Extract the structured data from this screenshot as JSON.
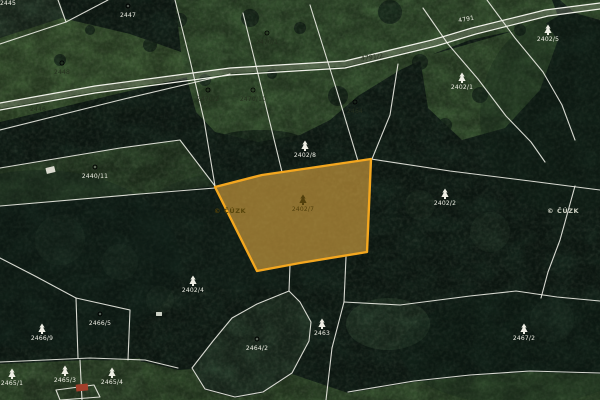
{
  "map": {
    "type": "cadastral-satellite-view",
    "colors": {
      "highlight_fill": "#e9ae43",
      "highlight_stroke": "#f4a71f",
      "boundary_line": "#f2f2ea",
      "meadow_green": "#5b8a51",
      "forest_green": "#20392b"
    },
    "highlighted_parcel": {
      "number": "2402/7",
      "symbol": "conifer"
    },
    "labels": [
      {
        "x": 303,
        "y": 200,
        "text": "2402/7",
        "symbol": "conifer",
        "tone": "accent",
        "rot": 0
      },
      {
        "x": 208,
        "y": 90,
        "text": "2470/2",
        "symbol": "circle",
        "tone": "dark",
        "rot": 0
      },
      {
        "x": 253,
        "y": 90,
        "text": "2470/10",
        "symbol": "circle",
        "tone": "dark",
        "rot": 0
      },
      {
        "x": 267,
        "y": 33,
        "text": "2470/1",
        "symbol": "circle",
        "tone": "dark",
        "rot": 0
      },
      {
        "x": 355,
        "y": 102,
        "text": "2464",
        "symbol": "circle",
        "tone": "dark",
        "rot": 0
      },
      {
        "x": 462,
        "y": 78,
        "text": "2402/1",
        "symbol": "conifer",
        "tone": "light",
        "rot": 0
      },
      {
        "x": 62,
        "y": 63,
        "text": "2448",
        "symbol": "circle",
        "tone": "dark",
        "rot": 0
      },
      {
        "x": 95,
        "y": 167,
        "text": "2440/11",
        "symbol": "circle",
        "tone": "light",
        "rot": 0
      },
      {
        "x": 305,
        "y": 146,
        "text": "2402/8",
        "symbol": "conifer",
        "tone": "light",
        "rot": 0
      },
      {
        "x": 445,
        "y": 194,
        "text": "2402/2",
        "symbol": "conifer",
        "tone": "light",
        "rot": 0
      },
      {
        "x": 548,
        "y": 30,
        "text": "2402/5",
        "symbol": "conifer",
        "tone": "light",
        "rot": 0
      },
      {
        "x": 128,
        "y": 6,
        "text": "2447",
        "symbol": "circle",
        "tone": "light",
        "rot": 0
      },
      {
        "x": 193,
        "y": 281,
        "text": "2402/4",
        "symbol": "conifer",
        "tone": "light",
        "rot": 0
      },
      {
        "x": 257,
        "y": 339,
        "text": "2464/2",
        "symbol": "circle",
        "tone": "light",
        "rot": 0
      },
      {
        "x": 322,
        "y": 324,
        "text": "2463",
        "symbol": "conifer",
        "tone": "light",
        "rot": 0
      },
      {
        "x": 524,
        "y": 329,
        "text": "2467/2",
        "symbol": "conifer",
        "tone": "light",
        "rot": 0
      },
      {
        "x": 42,
        "y": 329,
        "text": "2466/9",
        "symbol": "conifer",
        "tone": "light",
        "rot": 0
      },
      {
        "x": 100,
        "y": 314,
        "text": "2466/5",
        "symbol": "circle",
        "tone": "light",
        "rot": 0
      },
      {
        "x": 12,
        "y": 374,
        "text": "2465/1",
        "symbol": "conifer",
        "tone": "light",
        "rot": 0
      },
      {
        "x": 65,
        "y": 371,
        "text": "2465/3",
        "symbol": "conifer",
        "tone": "light",
        "rot": 0
      },
      {
        "x": 112,
        "y": 373,
        "text": "2465/4",
        "symbol": "conifer",
        "tone": "light",
        "rot": 0
      },
      {
        "x": 372,
        "y": 56,
        "text": "4791/2",
        "symbol": "none",
        "tone": "dark",
        "rot": -7
      },
      {
        "x": 466,
        "y": 18,
        "text": "4791",
        "symbol": "none",
        "tone": "light",
        "rot": -10
      },
      {
        "x": 38,
        "y": 108,
        "text": "2446",
        "symbol": "none",
        "tone": "dark",
        "rot": 0
      },
      {
        "x": 8,
        "y": 2,
        "text": "2445",
        "symbol": "none",
        "tone": "light",
        "rot": 0
      }
    ],
    "watermarks": [
      {
        "x": 214,
        "y": 213,
        "text": "© ČÚZK",
        "tone": "dark"
      },
      {
        "x": 547,
        "y": 213,
        "text": "© ČÚZK",
        "tone": "light"
      }
    ],
    "buildings": [
      {
        "x": 76,
        "y": 384,
        "w": 12,
        "h": 7,
        "color": "#a23f2b",
        "rot": -6
      },
      {
        "x": 46,
        "y": 167,
        "w": 9,
        "h": 6,
        "color": "#dadacf",
        "rot": -14
      },
      {
        "x": 156,
        "y": 312,
        "w": 6,
        "h": 4,
        "color": "#cdd2c6",
        "rot": 0
      }
    ]
  }
}
